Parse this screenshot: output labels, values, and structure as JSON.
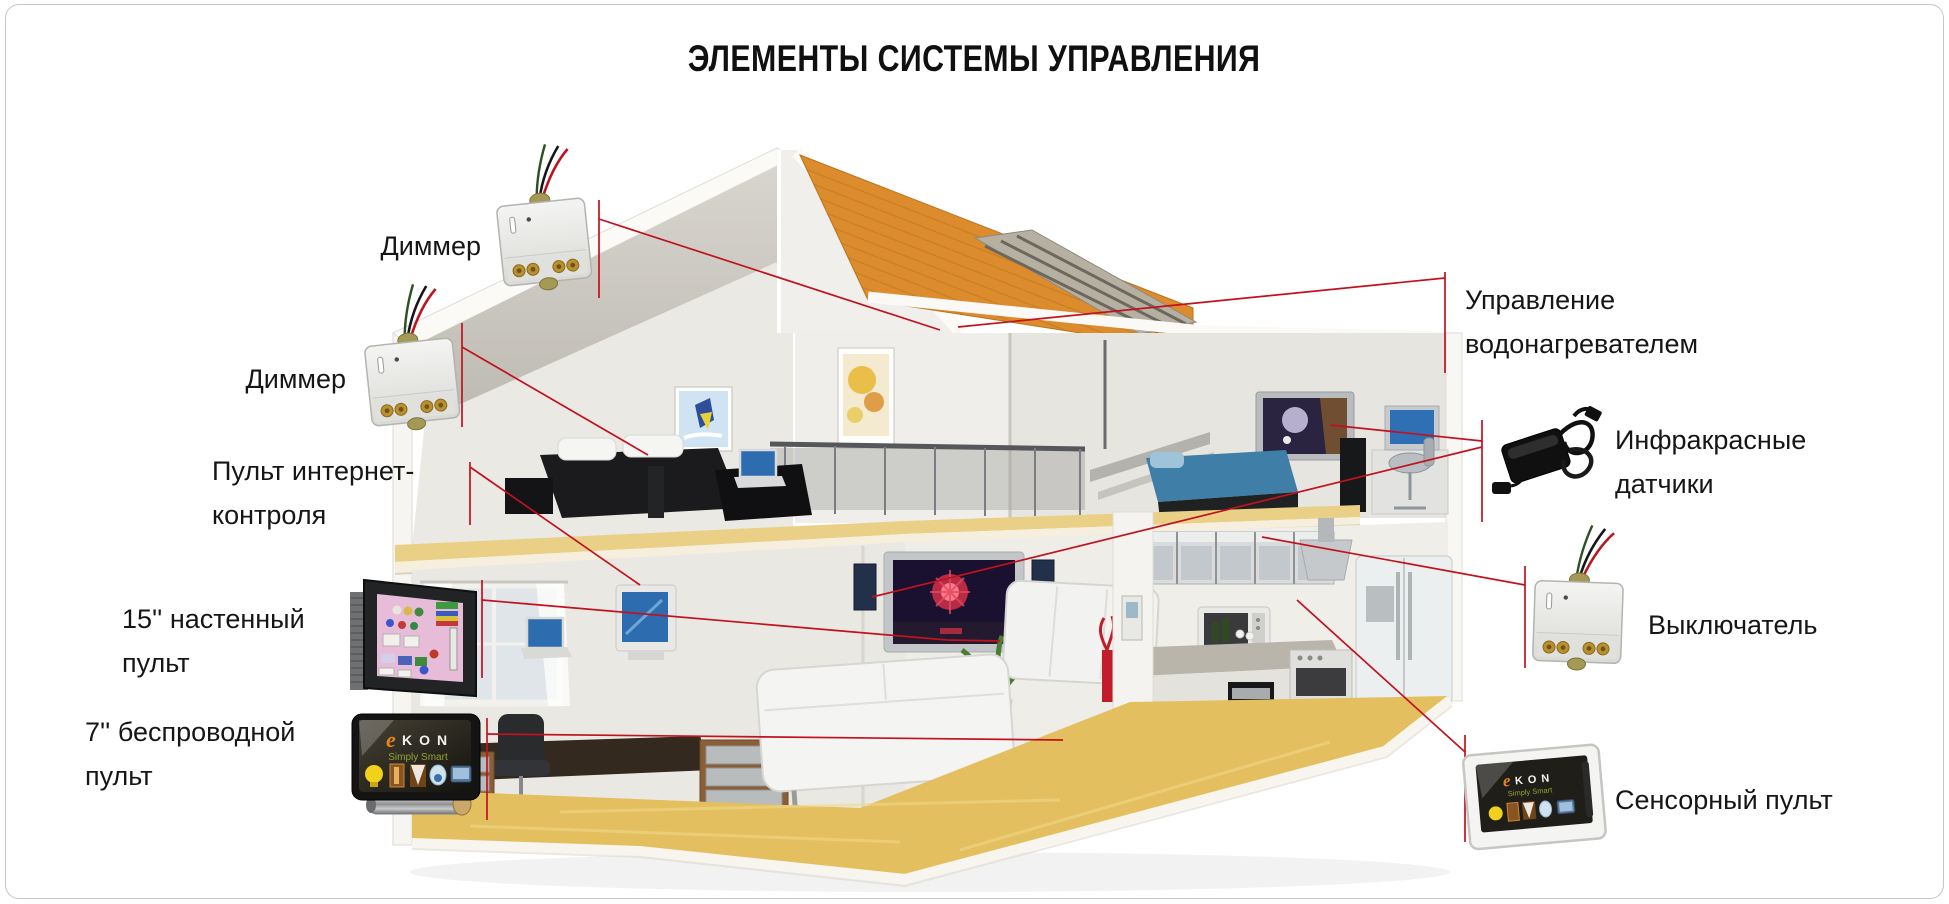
{
  "title": "ЭЛЕМЕНТЫ СИСТЕМЫ УПРАВЛЕНИЯ",
  "labels": {
    "dimmer_top": {
      "lines": [
        "Диммер"
      ]
    },
    "dimmer_bottom": {
      "lines": [
        "Диммер"
      ]
    },
    "internet_control": {
      "lines": [
        "Пульт интернет-",
        "контроля"
      ]
    },
    "wall_panel_15": {
      "lines": [
        "15'' настенный",
        "пульт"
      ]
    },
    "wireless_panel_7": {
      "lines": [
        "7'' беспроводной",
        "пульт"
      ]
    },
    "water_heater": {
      "lines": [
        "Управление",
        "водонагревателем"
      ]
    },
    "ir_sensors": {
      "lines": [
        "Инфракрасные",
        "датчики"
      ]
    },
    "switch": {
      "lines": [
        "Выключатель"
      ]
    },
    "touch_panel": {
      "lines": [
        "Сенсорный пульт"
      ]
    }
  },
  "devices": {
    "ekon_brand": {
      "logo_accent": "e",
      "logo_text": "KON",
      "tagline": "Simply Smart"
    }
  },
  "colors": {
    "callout_line": "#c1121f",
    "roof": "#dc8b2d",
    "floor": "#e3bf5f",
    "text": "#161616",
    "ekon_orange": "#e8851a",
    "ekon_green": "#93a32f"
  }
}
